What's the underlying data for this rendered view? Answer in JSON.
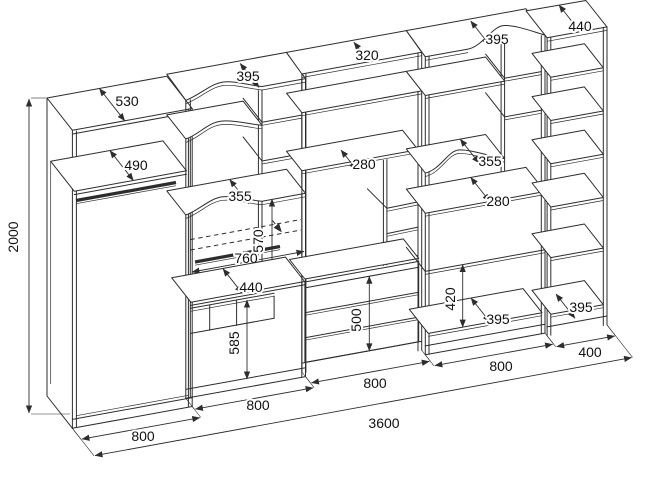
{
  "drawing": {
    "kind": "furniture wall-unit technical drawing",
    "colors": {
      "line": "#2d2d2d",
      "background": "#ffffff"
    },
    "dims": {
      "total_height": "2000",
      "total_width": "3600",
      "s1": {
        "width": "800",
        "top_depth": "530",
        "shelf_depth": "490"
      },
      "s2": {
        "width": "800",
        "top_depth": "395",
        "shelf_depth": "355",
        "pullout_width": "760",
        "pullout_height": "570",
        "foldout_depth": "440",
        "base_height": "585"
      },
      "s3": {
        "width": "800",
        "top_depth": "320",
        "shelf_depth": "280",
        "drawers_height": "500"
      },
      "s4": {
        "width": "800",
        "top_depth": "395",
        "shelf_depth": "355",
        "lower_shelf_depth": "280",
        "niche_height": "420",
        "niche_floor_depth": "395"
      },
      "s5": {
        "width": "400",
        "top_depth": "440",
        "shelf_depth": "395"
      }
    }
  }
}
